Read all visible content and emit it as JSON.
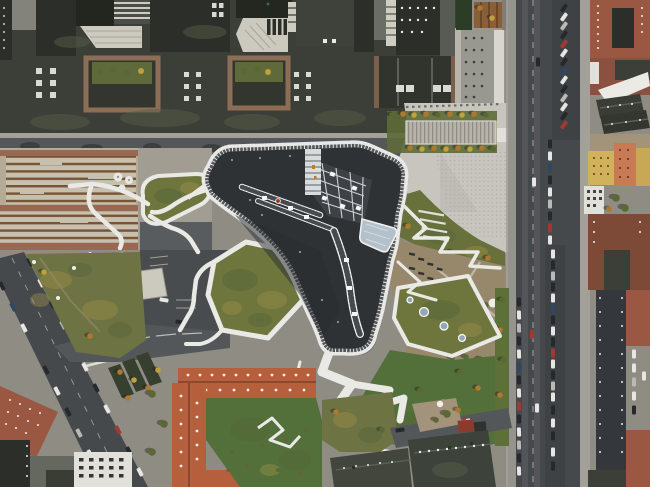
{
  "image": {
    "type": "aerial-photograph",
    "caption": "Aerial drone view of a boomerang-shaped campus building with a dark roof and white-edged rim, surrounded by angular green roofs, winding white paths, a light stone plaza, city streets with parked cars, and brick housing blocks",
    "width": 650,
    "height": 487
  },
  "palette": {
    "ground": "#8f8c84",
    "roofDark": "#3c3f38",
    "roofDarker": "#2b2e29",
    "roofMoss": "#565b48",
    "skylight": "#dadad4",
    "stepLight": "#ccc9bf",
    "plaza": "#c8c5be",
    "plazaDot": "#a5a29a",
    "road": "#54575a",
    "roadDark": "#46494c",
    "sidewalk": "#a3a09a",
    "pathWhite": "#e9e9e5",
    "buildingRoof": "#2e3235",
    "rimWhite": "#e8e8e6",
    "rimTick": "#3a3e41",
    "glassFrame": "#eef0f1",
    "glassDark": "#454a4e",
    "atrium": "#b5c1ca",
    "greenRoof": "#6e763e",
    "greenDark": "#55643a",
    "lawn": "#53703a",
    "scrub": "#6d7342",
    "autumn1": "#a5924a",
    "dirt": "#97886c",
    "gravel": "#a2937a",
    "brickRed": "#9a5742",
    "brickFrame": "#8c6e57",
    "gardenGreen": "#5e6a39",
    "tileOrange": "#b55f3d",
    "tileRidge": "#8c4930",
    "yellowBldg": "#d2b15c",
    "salmonBldg": "#c87a55",
    "whiteBldg": "#e2e0da",
    "churchRoof": "#42463d",
    "carWhite": "#e6e6e4",
    "carDark": "#25282c",
    "carRed": "#a23832",
    "carBlue": "#2e4764",
    "treeOlive": "#5c6834",
    "treeOrange": "#b0782f",
    "treeYellow": "#bfa03c",
    "redDot": "#b03527",
    "shadow": "rgba(25,28,24,0.40)",
    "wood": "#775434",
    "benchBase": "#c7c0af",
    "paving": "#96604a"
  }
}
